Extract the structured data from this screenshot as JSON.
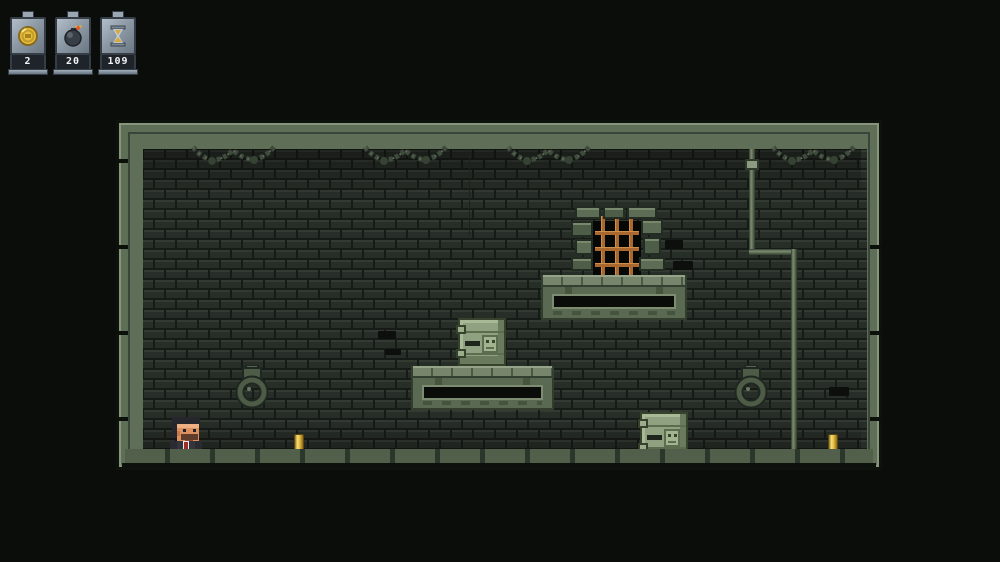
{
  "hud": {
    "counters": [
      {
        "name": "coins",
        "icon": "coin-icon",
        "value": "2"
      },
      {
        "name": "bombs",
        "icon": "bomb-icon",
        "value": "20"
      },
      {
        "name": "timer",
        "icon": "hourglass-icon",
        "value": "109"
      }
    ]
  },
  "colors": {
    "background": "#0a0d0a",
    "frame_green": "#5f6e56",
    "brick": "#262c26",
    "platform_green": "#5a6951",
    "coin_gold": "#e2b93e",
    "jail_bar_orange": "#a8682f",
    "tie_red": "#9e2f28",
    "hud_steel": "#8d9aa6"
  },
  "scene": {
    "entities": [
      "player-character",
      "gold-bar-coin-left",
      "gold-bar-coin-right",
      "crate-on-platform",
      "crate-on-floor",
      "jail-window",
      "wall-ring-left",
      "wall-ring-right",
      "ceiling-chains",
      "hanging-chain",
      "wall-pipe",
      "upper-platform",
      "middle-platform",
      "floor-ledge"
    ]
  }
}
